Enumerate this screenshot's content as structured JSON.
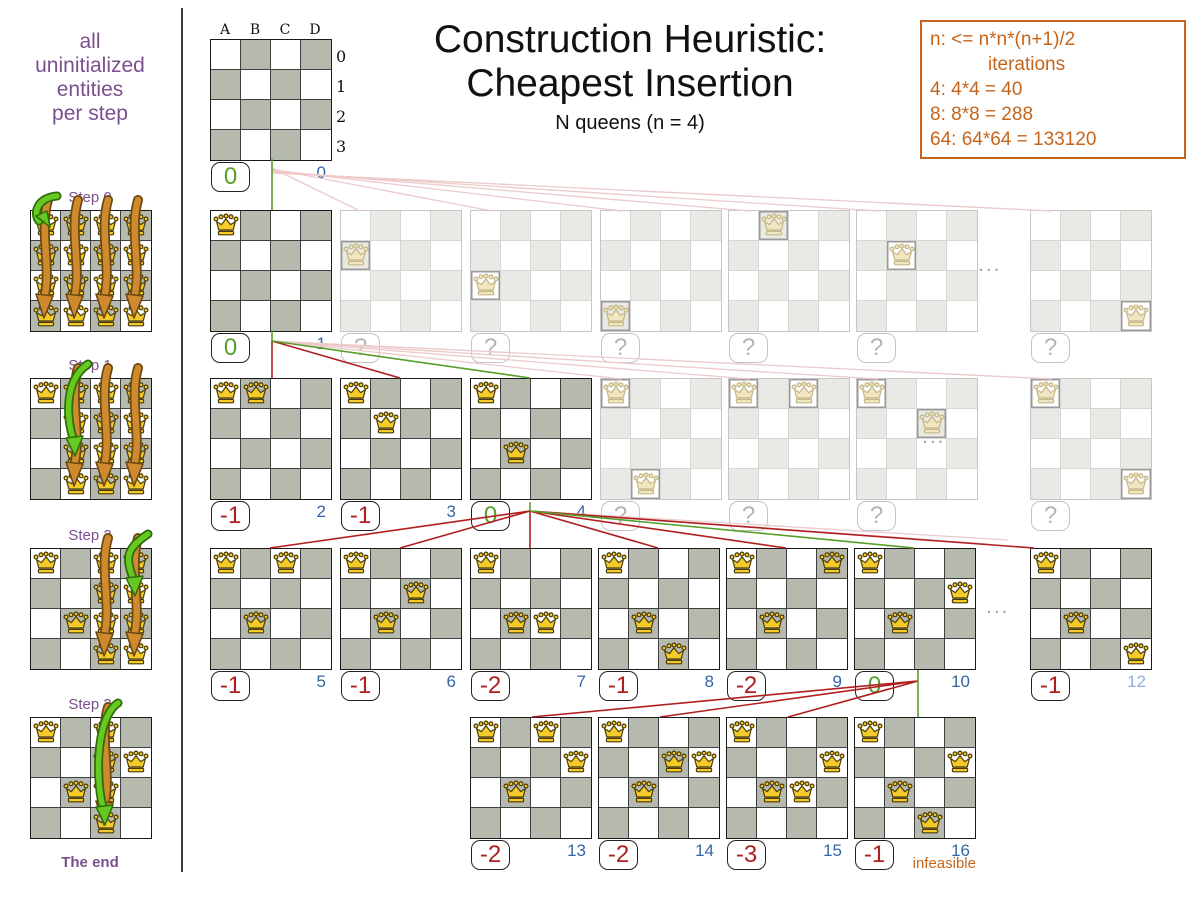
{
  "colors": {
    "purple": "#7b4f8e",
    "orange": "#c5651c",
    "green": "#55a02a",
    "red": "#b01f1f",
    "blue": "#3465a4"
  },
  "sidebar": {
    "caption": "all\nuninitialized\nentities\nper step",
    "end_label": "The end",
    "steps": [
      {
        "label": "Step 0",
        "y": 210,
        "fill_all": true,
        "settled": [],
        "full_cols": [
          0,
          1,
          2,
          3
        ],
        "green": {
          "col": 0,
          "row": 0,
          "short": true
        }
      },
      {
        "label": "Step 1",
        "y": 378,
        "fill_all": false,
        "settled": [
          [
            0,
            0
          ]
        ],
        "full_cols": [
          1,
          2,
          3
        ],
        "green": {
          "col": 1,
          "row": 2,
          "short": false
        }
      },
      {
        "label": "Step 2",
        "y": 548,
        "fill_all": false,
        "settled": [
          [
            0,
            0
          ],
          [
            1,
            2
          ]
        ],
        "full_cols": [
          2,
          3
        ],
        "green": {
          "col": 3,
          "row": 1,
          "short": false
        }
      },
      {
        "label": "Step 3",
        "y": 717,
        "fill_all": false,
        "settled": [
          [
            0,
            0
          ],
          [
            1,
            2
          ],
          [
            3,
            1
          ]
        ],
        "full_cols": [
          2
        ],
        "green": {
          "col": 2,
          "row": 3,
          "short": false
        }
      }
    ]
  },
  "header": {
    "title_line1": "Construction Heuristic:",
    "title_line2": "Cheapest Insertion",
    "subtitle": "N queens (n = 4)"
  },
  "notes": {
    "lines": [
      {
        "text": "n: <= n*n*(n+1)/2",
        "indent": false
      },
      {
        "text": "iterations",
        "indent": true
      },
      {
        "text": "4: 4*4 = 40",
        "indent": false
      },
      {
        "text": "8: 8*8 = 288",
        "indent": false
      },
      {
        "text": "64: 64*64 = 133120",
        "indent": false
      }
    ]
  },
  "root_labels": {
    "cols": [
      "A",
      "B",
      "C",
      "D"
    ],
    "rows": [
      "0",
      "1",
      "2",
      "3"
    ]
  },
  "boards": [
    {
      "x": 210,
      "y": 39,
      "state": "solid",
      "queens": [],
      "score": "0",
      "tone": "good",
      "iter": "0",
      "labels": true
    },
    {
      "x": 210,
      "y": 210,
      "state": "solid",
      "queens": [
        [
          0,
          0
        ]
      ],
      "score": "0",
      "tone": "good",
      "iter": "1"
    },
    {
      "x": 340,
      "y": 210,
      "state": "faded",
      "queens": [
        [
          0,
          1
        ]
      ],
      "score": "?",
      "tone": "unknown"
    },
    {
      "x": 470,
      "y": 210,
      "state": "faded",
      "queens": [
        [
          0,
          2
        ]
      ],
      "score": "?",
      "tone": "unknown"
    },
    {
      "x": 600,
      "y": 210,
      "state": "faded",
      "queens": [
        [
          0,
          3
        ]
      ],
      "score": "?",
      "tone": "unknown"
    },
    {
      "x": 728,
      "y": 210,
      "state": "faded",
      "queens": [
        [
          1,
          0
        ]
      ],
      "score": "?",
      "tone": "unknown"
    },
    {
      "x": 856,
      "y": 210,
      "state": "faded",
      "queens": [
        [
          1,
          1
        ]
      ],
      "score": "?",
      "tone": "unknown"
    },
    {
      "x": 1030,
      "y": 210,
      "state": "faded",
      "queens": [
        [
          3,
          3
        ]
      ],
      "score": "?",
      "tone": "unknown"
    },
    {
      "x": 210,
      "y": 378,
      "state": "solid",
      "queens": [
        [
          0,
          0
        ],
        [
          1,
          0
        ]
      ],
      "score": "-1",
      "tone": "bad",
      "iter": "2"
    },
    {
      "x": 340,
      "y": 378,
      "state": "solid",
      "queens": [
        [
          0,
          0
        ],
        [
          1,
          1
        ]
      ],
      "score": "-1",
      "tone": "bad",
      "iter": "3"
    },
    {
      "x": 470,
      "y": 378,
      "state": "solid",
      "queens": [
        [
          0,
          0
        ],
        [
          1,
          2
        ]
      ],
      "score": "0",
      "tone": "good",
      "iter": "4"
    },
    {
      "x": 600,
      "y": 378,
      "state": "faded",
      "queens": [
        [
          0,
          0
        ],
        [
          1,
          3
        ]
      ],
      "score": "?",
      "tone": "unknown"
    },
    {
      "x": 728,
      "y": 378,
      "state": "faded",
      "queens": [
        [
          0,
          0
        ],
        [
          2,
          0
        ]
      ],
      "score": "?",
      "tone": "unknown"
    },
    {
      "x": 856,
      "y": 378,
      "state": "faded",
      "queens": [
        [
          0,
          0
        ],
        [
          2,
          1
        ]
      ],
      "score": "?",
      "tone": "unknown"
    },
    {
      "x": 1030,
      "y": 378,
      "state": "faded",
      "queens": [
        [
          0,
          0
        ],
        [
          3,
          3
        ]
      ],
      "score": "?",
      "tone": "unknown"
    },
    {
      "x": 210,
      "y": 548,
      "state": "solid",
      "queens": [
        [
          0,
          0
        ],
        [
          1,
          2
        ],
        [
          2,
          0
        ]
      ],
      "score": "-1",
      "tone": "bad",
      "iter": "5"
    },
    {
      "x": 340,
      "y": 548,
      "state": "solid",
      "queens": [
        [
          0,
          0
        ],
        [
          1,
          2
        ],
        [
          2,
          1
        ]
      ],
      "score": "-1",
      "tone": "bad",
      "iter": "6"
    },
    {
      "x": 470,
      "y": 548,
      "state": "solid",
      "queens": [
        [
          0,
          0
        ],
        [
          1,
          2
        ],
        [
          2,
          2
        ]
      ],
      "score": "-2",
      "tone": "bad",
      "iter": "7"
    },
    {
      "x": 598,
      "y": 548,
      "state": "solid",
      "queens": [
        [
          0,
          0
        ],
        [
          1,
          2
        ],
        [
          2,
          3
        ]
      ],
      "score": "-1",
      "tone": "bad",
      "iter": "8"
    },
    {
      "x": 726,
      "y": 548,
      "state": "solid",
      "queens": [
        [
          0,
          0
        ],
        [
          1,
          2
        ],
        [
          3,
          0
        ]
      ],
      "score": "-2",
      "tone": "bad",
      "iter": "9"
    },
    {
      "x": 854,
      "y": 548,
      "state": "solid",
      "queens": [
        [
          0,
          0
        ],
        [
          1,
          2
        ],
        [
          3,
          1
        ]
      ],
      "score": "0",
      "tone": "good",
      "iter": "10"
    },
    {
      "x": 1030,
      "y": 548,
      "state": "solid",
      "queens": [
        [
          0,
          0
        ],
        [
          1,
          2
        ],
        [
          3,
          3
        ]
      ],
      "score": "-1",
      "tone": "bad",
      "iter": "12",
      "iter_faded": true
    },
    {
      "x": 470,
      "y": 717,
      "state": "solid",
      "queens": [
        [
          0,
          0
        ],
        [
          2,
          0
        ],
        [
          3,
          1
        ],
        [
          1,
          2
        ]
      ],
      "score": "-2",
      "tone": "bad",
      "iter": "13"
    },
    {
      "x": 598,
      "y": 717,
      "state": "solid",
      "queens": [
        [
          0,
          0
        ],
        [
          2,
          1
        ],
        [
          3,
          1
        ],
        [
          1,
          2
        ]
      ],
      "score": "-2",
      "tone": "bad",
      "iter": "14"
    },
    {
      "x": 726,
      "y": 717,
      "state": "solid",
      "queens": [
        [
          0,
          0
        ],
        [
          3,
          1
        ],
        [
          1,
          2
        ],
        [
          2,
          2
        ]
      ],
      "score": "-3",
      "tone": "bad",
      "iter": "15"
    },
    {
      "x": 854,
      "y": 717,
      "state": "solid",
      "queens": [
        [
          0,
          0
        ],
        [
          3,
          1
        ],
        [
          1,
          2
        ],
        [
          2,
          3
        ]
      ],
      "score": "-1",
      "tone": "bad",
      "iter": "16",
      "note": "infeasible"
    }
  ],
  "ellipses": [
    {
      "x": 978,
      "y": 253
    },
    {
      "x": 922,
      "y": 425
    },
    {
      "x": 986,
      "y": 595
    }
  ],
  "edges": [
    {
      "x1": 272,
      "y1": 168,
      "x2": 360,
      "y2": 211,
      "c": "pink"
    },
    {
      "x1": 272,
      "y1": 169,
      "x2": 492,
      "y2": 211,
      "c": "pink"
    },
    {
      "x1": 272,
      "y1": 170,
      "x2": 622,
      "y2": 211,
      "c": "pink"
    },
    {
      "x1": 272,
      "y1": 171,
      "x2": 750,
      "y2": 211,
      "c": "pink"
    },
    {
      "x1": 272,
      "y1": 172,
      "x2": 878,
      "y2": 211,
      "c": "pink"
    },
    {
      "x1": 272,
      "y1": 173,
      "x2": 1052,
      "y2": 211,
      "c": "pink"
    },
    {
      "x1": 272,
      "y1": 341,
      "x2": 622,
      "y2": 379,
      "c": "pink"
    },
    {
      "x1": 272,
      "y1": 341,
      "x2": 750,
      "y2": 379,
      "c": "pink"
    },
    {
      "x1": 272,
      "y1": 341,
      "x2": 878,
      "y2": 379,
      "c": "pink"
    },
    {
      "x1": 272,
      "y1": 341,
      "x2": 1052,
      "y2": 379,
      "c": "pink"
    },
    {
      "x1": 530,
      "y1": 511,
      "x2": 988,
      "y2": 544,
      "c": "pink"
    },
    {
      "x1": 530,
      "y1": 511,
      "x2": 1008,
      "y2": 540,
      "c": "pink"
    },
    {
      "x1": 272,
      "y1": 159,
      "x2": 272,
      "y2": 210,
      "c": "green"
    },
    {
      "x1": 272,
      "y1": 330,
      "x2": 272,
      "y2": 341,
      "c": "green"
    },
    {
      "x1": 272,
      "y1": 341,
      "x2": 272,
      "y2": 378,
      "c": "red"
    },
    {
      "x1": 272,
      "y1": 341,
      "x2": 400,
      "y2": 378,
      "c": "red"
    },
    {
      "x1": 272,
      "y1": 341,
      "x2": 530,
      "y2": 378,
      "c": "green"
    },
    {
      "x1": 530,
      "y1": 502,
      "x2": 530,
      "y2": 511,
      "c": "green"
    },
    {
      "x1": 530,
      "y1": 511,
      "x2": 270,
      "y2": 548,
      "c": "red"
    },
    {
      "x1": 530,
      "y1": 511,
      "x2": 400,
      "y2": 548,
      "c": "red"
    },
    {
      "x1": 530,
      "y1": 511,
      "x2": 530,
      "y2": 548,
      "c": "red"
    },
    {
      "x1": 530,
      "y1": 511,
      "x2": 658,
      "y2": 548,
      "c": "red"
    },
    {
      "x1": 530,
      "y1": 511,
      "x2": 786,
      "y2": 548,
      "c": "red"
    },
    {
      "x1": 530,
      "y1": 511,
      "x2": 914,
      "y2": 548,
      "c": "green"
    },
    {
      "x1": 530,
      "y1": 511,
      "x2": 1034,
      "y2": 548,
      "c": "red"
    },
    {
      "x1": 918,
      "y1": 670,
      "x2": 918,
      "y2": 717,
      "c": "green"
    },
    {
      "x1": 918,
      "y1": 681,
      "x2": 532,
      "y2": 717,
      "c": "red"
    },
    {
      "x1": 918,
      "y1": 681,
      "x2": 660,
      "y2": 717,
      "c": "red"
    },
    {
      "x1": 918,
      "y1": 681,
      "x2": 788,
      "y2": 717,
      "c": "red"
    }
  ]
}
